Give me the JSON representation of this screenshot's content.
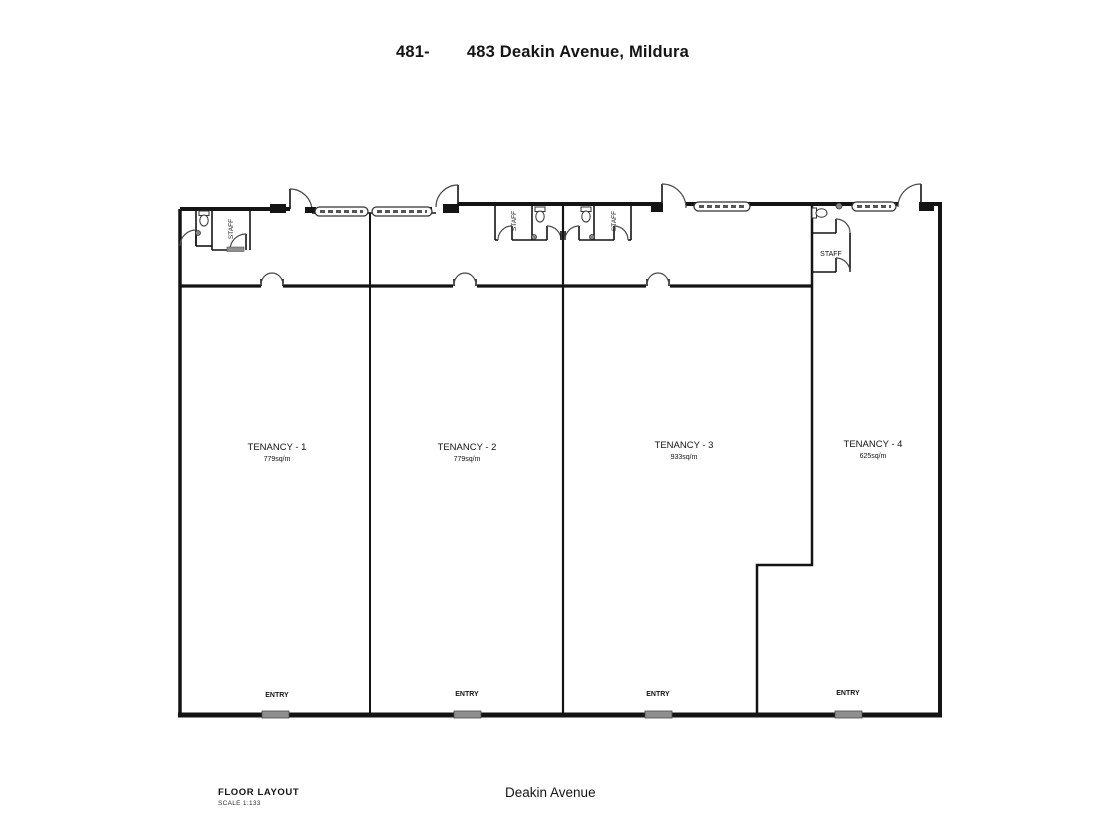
{
  "header": {
    "title_prefix": "481-",
    "title_main": "483 Deakin Avenue, Mildura"
  },
  "plan": {
    "tenancies": [
      {
        "name": "TENANCY - 1",
        "area": "779sq/m",
        "entry_label": "ENTRY",
        "staff_label": "STAFF"
      },
      {
        "name": "TENANCY - 2",
        "area": "779sq/m",
        "entry_label": "ENTRY",
        "staff_label": "STAFF"
      },
      {
        "name": "TENANCY - 3",
        "area": "933sq/m",
        "entry_label": "ENTRY",
        "staff_label": "STAFF"
      },
      {
        "name": "TENANCY - 4",
        "area": "625sq/m",
        "entry_label": "ENTRY",
        "staff_label": "STAFF"
      }
    ]
  },
  "footer": {
    "drawing_title": "FLOOR LAYOUT",
    "scale": "SCALE 1:133",
    "street": "Deakin Avenue"
  },
  "colors": {
    "wall": "#141414",
    "door_arc": "#4a4a4a",
    "entry_door": "#8f8f8f",
    "background": "#ffffff"
  }
}
